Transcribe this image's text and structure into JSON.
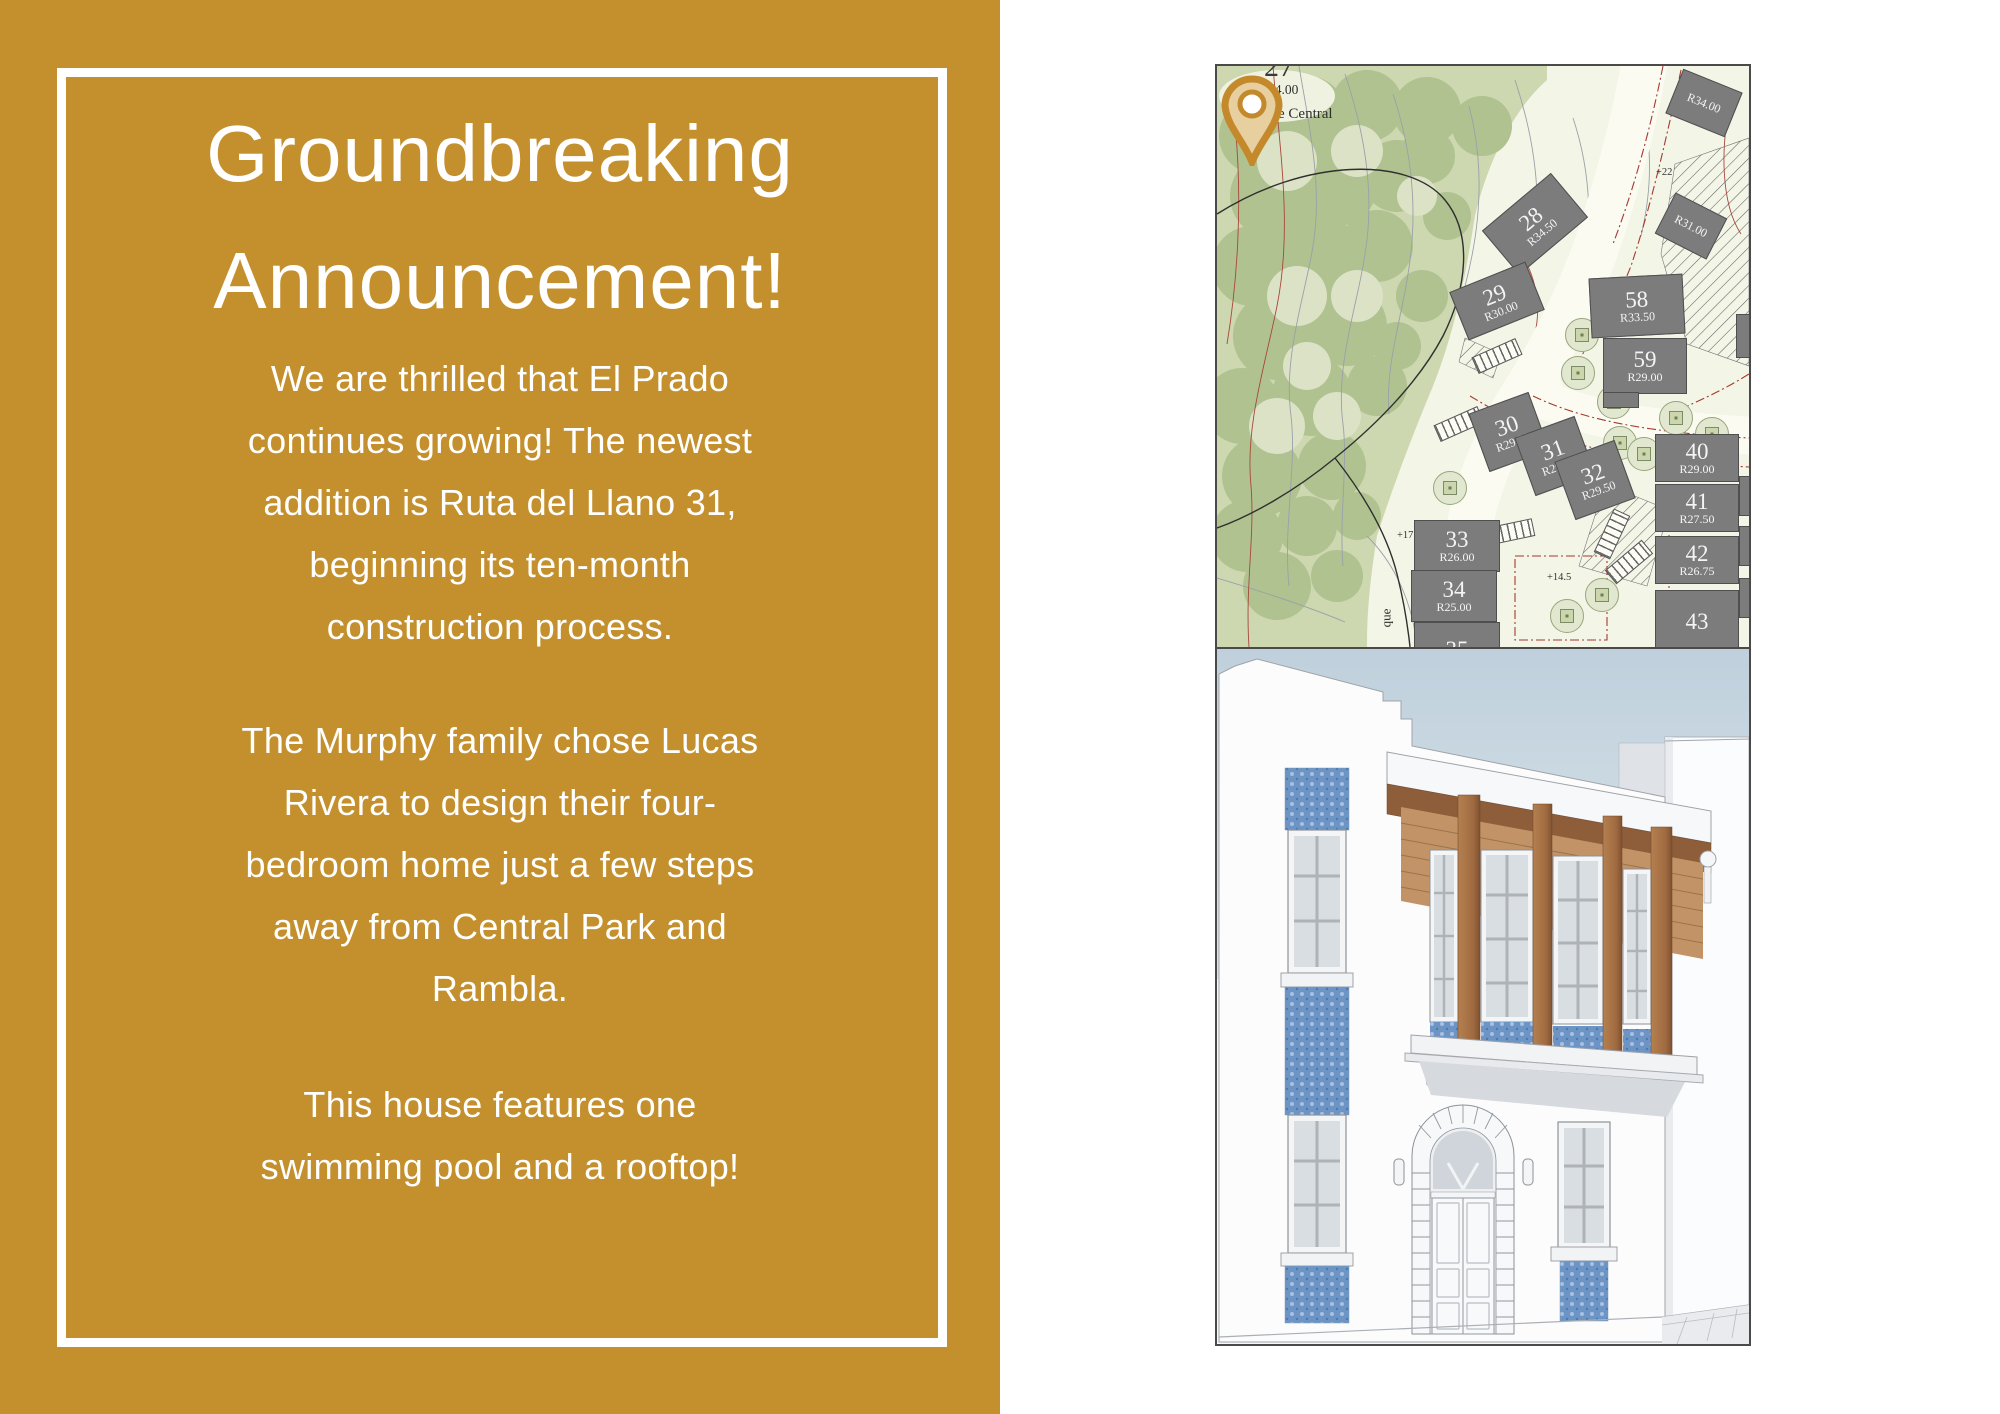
{
  "page": {
    "background": "#FFFFFF"
  },
  "poster": {
    "background": "#C4902E",
    "border_color": "#FFFFFF",
    "text_color": "#FFFFFF",
    "title": "Groundbreaking\nAnnouncement!",
    "paragraphs": [
      "We are thrilled that El Prado\ncontinues growing! The newest\naddition is Ruta del Llano 31,\nbeginning its ten-month\nconstruction process.",
      "The Murphy family chose Lucas\nRivera to design their four-\nbedroom home just a few steps\naway from Central Park and\nRambla.",
      "This house features one\nswimming pool and a rooftop!"
    ]
  },
  "site_plan": {
    "park_label": "Parque Central",
    "cut_lot_number": "27",
    "cut_lot_setback": "R24.00",
    "street_label": "Ruta del Llano",
    "vertical_street_label": "que",
    "highlight_pin": {
      "color": "#C3892B",
      "marks_lot": "31"
    },
    "spot_elevations": [
      {
        "label": "+22",
        "x": 439,
        "y": 101
      },
      {
        "label": "+17",
        "x": 180,
        "y": 464
      },
      {
        "label": "+14.5",
        "x": 330,
        "y": 506
      }
    ],
    "lots": [
      {
        "num": "28",
        "r": "R34.50",
        "cx": 318,
        "cy": 158,
        "w": 90,
        "h": 58,
        "rot": -40
      },
      {
        "num": "29",
        "r": "R30.00",
        "cx": 280,
        "cy": 235,
        "w": 82,
        "h": 52,
        "rot": -22
      },
      {
        "num": "",
        "r": "R34.00",
        "cx": 487,
        "cy": 37,
        "w": 64,
        "h": 48,
        "rot": 22
      },
      {
        "num": "",
        "r": "R31.00",
        "cx": 474,
        "cy": 160,
        "w": 58,
        "h": 46,
        "rot": 27
      },
      {
        "num": "58",
        "r": "R33.50",
        "cx": 420,
        "cy": 240,
        "w": 94,
        "h": 60,
        "rot": -3
      },
      {
        "num": "59",
        "r": "R29.00",
        "cx": 428,
        "cy": 300,
        "w": 84,
        "h": 56,
        "rot": 0
      },
      {
        "num": "30",
        "r": "R29.50",
        "cx": 292,
        "cy": 366,
        "w": 64,
        "h": 62,
        "rot": -20
      },
      {
        "num": "31",
        "r": "R29.50",
        "cx": 338,
        "cy": 390,
        "w": 64,
        "h": 62,
        "rot": -20
      },
      {
        "num": "32",
        "r": "R29.50",
        "cx": 378,
        "cy": 414,
        "w": 64,
        "h": 62,
        "rot": -20
      },
      {
        "num": "40",
        "r": "R29.00",
        "cx": 480,
        "cy": 392,
        "w": 84,
        "h": 48,
        "rot": 0
      },
      {
        "num": "41",
        "r": "R27.50",
        "cx": 480,
        "cy": 442,
        "w": 84,
        "h": 48,
        "rot": 0
      },
      {
        "num": "42",
        "r": "R26.75",
        "cx": 480,
        "cy": 494,
        "w": 84,
        "h": 48,
        "rot": 0
      },
      {
        "num": "43",
        "r": "",
        "cx": 480,
        "cy": 556,
        "w": 84,
        "h": 64,
        "rot": 0
      },
      {
        "num": "33",
        "r": "R26.00",
        "cx": 240,
        "cy": 480,
        "w": 86,
        "h": 52,
        "rot": 0
      },
      {
        "num": "34",
        "r": "R25.00",
        "cx": 237,
        "cy": 530,
        "w": 86,
        "h": 52,
        "rot": 0
      },
      {
        "num": "35",
        "r": "",
        "cx": 240,
        "cy": 584,
        "w": 86,
        "h": 56,
        "rot": 0
      },
      {
        "num": "",
        "r": "",
        "cx": 527,
        "cy": 270,
        "w": 16,
        "h": 44,
        "rot": 0
      },
      {
        "num": "",
        "r": "",
        "cx": 529,
        "cy": 430,
        "w": 14,
        "h": 40,
        "rot": 0
      },
      {
        "num": "",
        "r": "",
        "cx": 529,
        "cy": 480,
        "w": 14,
        "h": 40,
        "rot": 0
      },
      {
        "num": "",
        "r": "",
        "cx": 529,
        "cy": 532,
        "w": 14,
        "h": 40,
        "rot": 0
      },
      {
        "num": "",
        "r": "",
        "cx": 404,
        "cy": 334,
        "w": 36,
        "h": 16,
        "rot": 0
      }
    ],
    "trees": [
      [
        365,
        269
      ],
      [
        361,
        307
      ],
      [
        408,
        294
      ],
      [
        397,
        336
      ],
      [
        403,
        377
      ],
      [
        427,
        388
      ],
      [
        233,
        422
      ],
      [
        219,
        481
      ],
      [
        385,
        529
      ],
      [
        350,
        550
      ],
      [
        459,
        352
      ],
      [
        495,
        368
      ]
    ]
  },
  "elevation": {
    "sky_color": "#C6D5E0",
    "tile_color": "#6C95C6",
    "wood_color": "#A67147",
    "facade_color": "#FCFCFD"
  }
}
